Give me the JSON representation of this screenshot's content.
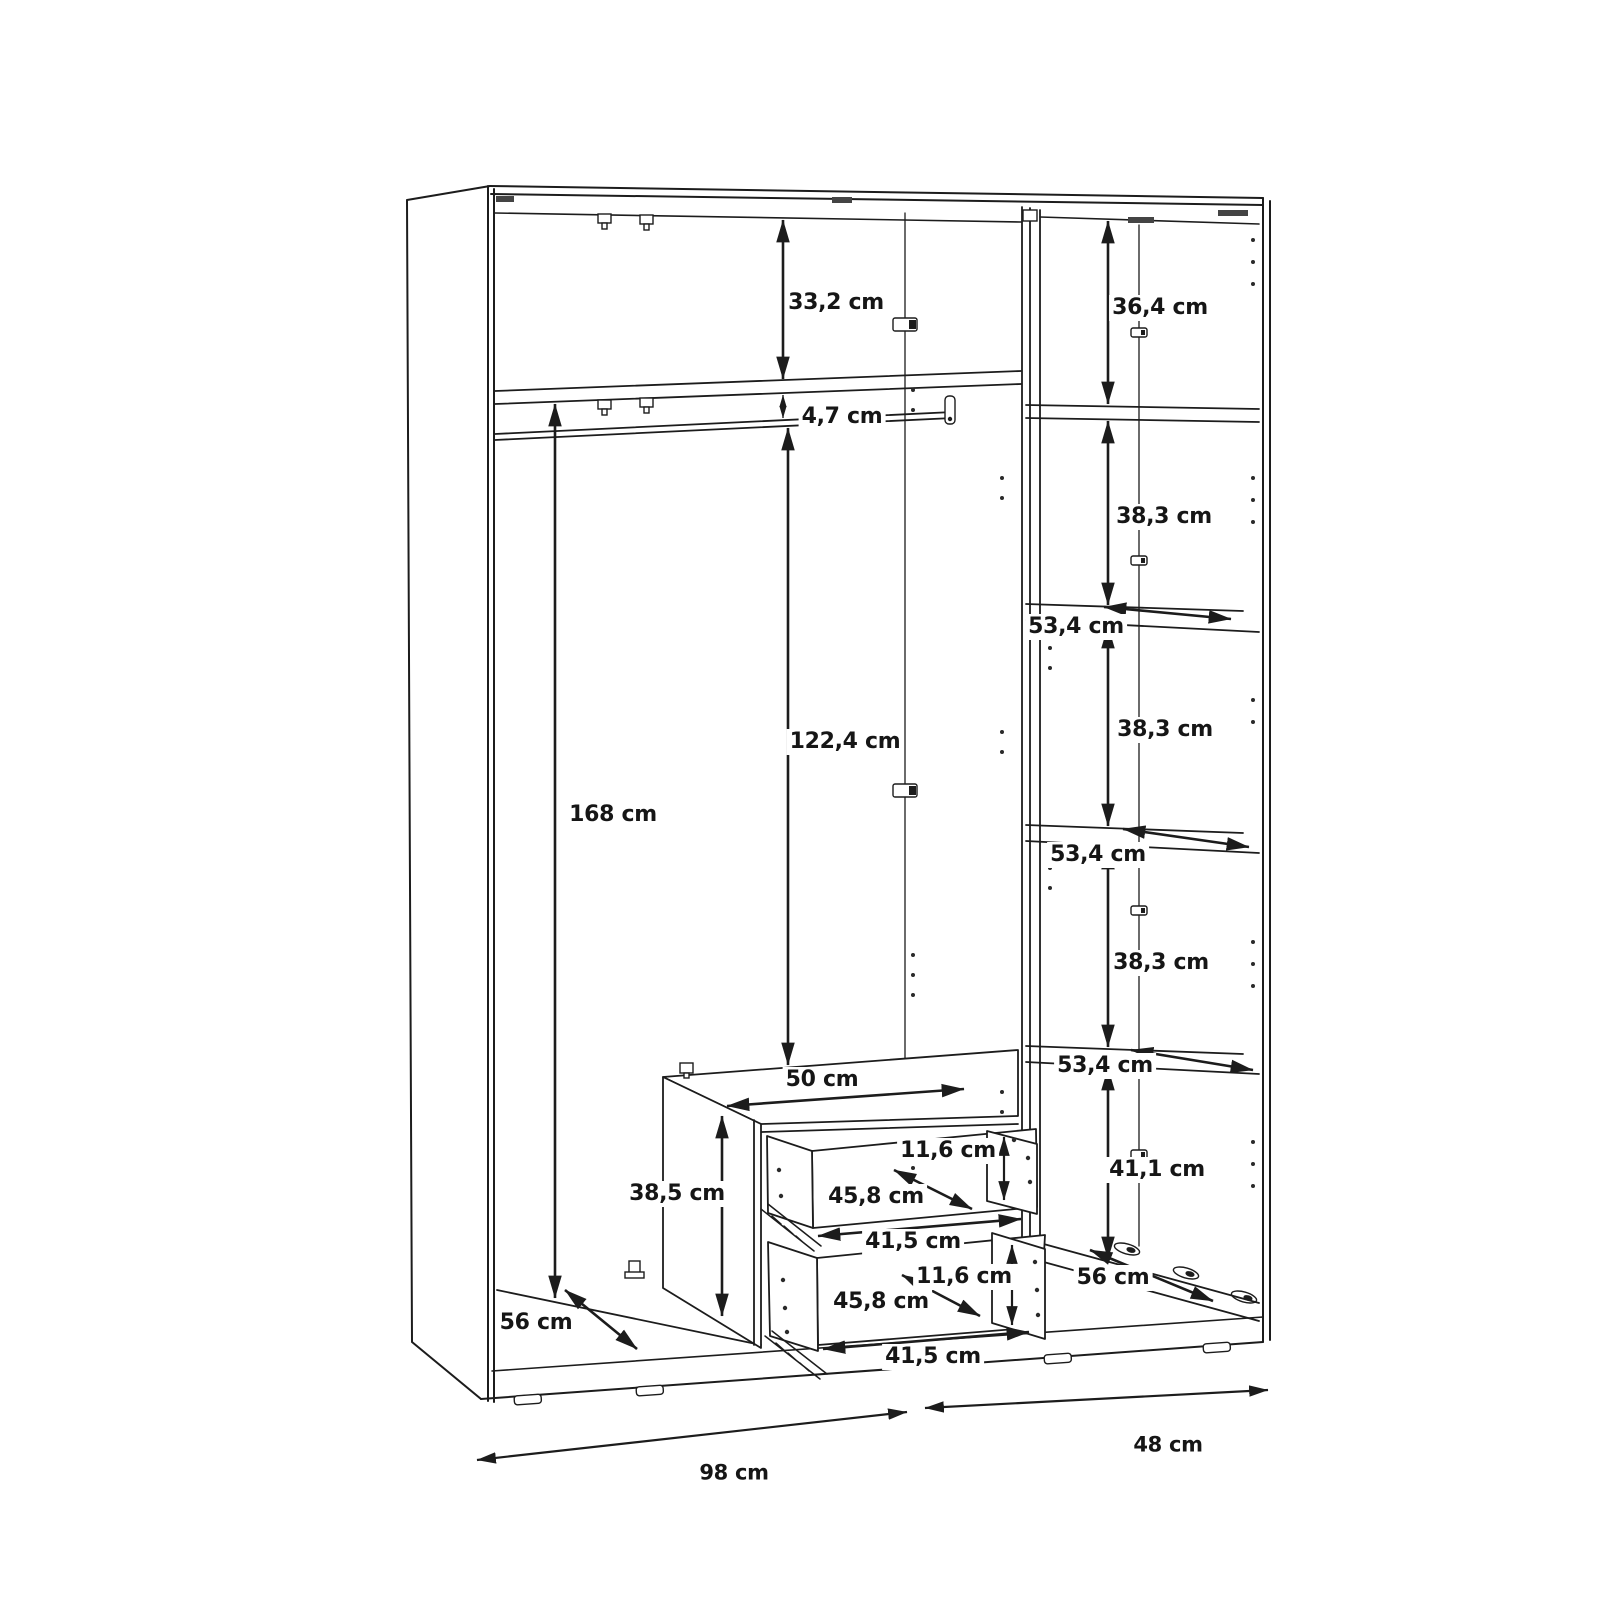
{
  "diagram": {
    "type": "wardrobe-interior-dimension-drawing",
    "unit": "cm",
    "line_color": "#1c1c1c",
    "background": "#ffffff"
  },
  "labels": {
    "left_top_height": "33,2 cm",
    "shelf_rod_gap": "4,7 cm",
    "left_interior_height": "168 cm",
    "rod_to_drawers": "122,4 cm",
    "right_top_height": "36,4 cm",
    "right_gap_1": "38,3 cm",
    "right_shelf_depth_1": "53,4 cm",
    "right_gap_2": "38,3 cm",
    "right_shelf_depth_2": "53,4 cm",
    "right_gap_3": "38,3 cm",
    "right_shelf_depth_3": "53,4 cm",
    "right_bottom_height": "41,1 cm",
    "right_floor_depth": "56 cm",
    "drawer_unit_width": "50 cm",
    "drawer_unit_height": "38,5 cm",
    "drawer1_height": "11,6 cm",
    "drawer1_depth": "45,8 cm",
    "drawer1_width": "41,5 cm",
    "drawer2_height": "11,6 cm",
    "drawer2_depth": "45,8 cm",
    "drawer2_width": "41,5 cm",
    "left_floor_depth": "56 cm",
    "left_unit_width": "98 cm",
    "right_unit_width": "48 cm"
  }
}
